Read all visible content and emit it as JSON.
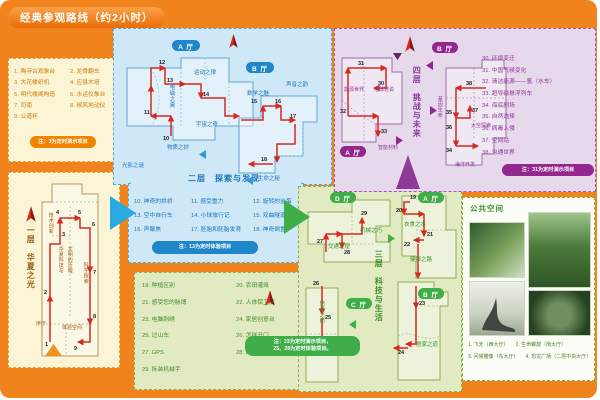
{
  "title": "经典参观路线（约2小时）",
  "colors": {
    "background_orange": "#f1831d",
    "route_red": "#d42b1e",
    "floor1_accent": "#cf7d0a",
    "floor2_accent": "#1b75bc",
    "floor3_accent": "#3e8f2f",
    "floor4_accent": "#8e3a96"
  },
  "floor1": {
    "title": "一层　华夏之光",
    "legend": [
      "1. 陶寺古观象台",
      "2. 龙骨翻车",
      "3. 大花楼织机",
      "4. 应县木塔",
      "5. 明代楼阁构造",
      "6. 水运仪象台",
      "7. 司南",
      "8. 候风地动仪",
      "9. 公道杯"
    ],
    "note": "注：3为定时演示项目",
    "areas": {
      "xu": "序厅",
      "jishu": "技术创新",
      "center1": "华夏科技与",
      "center2": "文明的历程",
      "kexue": "科学探索",
      "tiyan": "体验空间"
    },
    "route": [
      "1",
      "2",
      "3",
      "4",
      "5",
      "6",
      "7",
      "8",
      "9"
    ]
  },
  "floor2": {
    "title": "二层　探索与发现",
    "halls": [
      "A 厅",
      "B 厅"
    ],
    "areas": {
      "guangying": "光影之谜",
      "dianci": "电磁之奥",
      "yundong": "运动之律",
      "yuzhou": "宇宙之奇",
      "wuzhi": "物质之妙",
      "shuxue": "数学之魅",
      "shengyin": "声音之韵",
      "shengming": "生命之秘"
    },
    "legend": [
      "10. 神奇的拱桥",
      "11. 感受重力",
      "12. 旋转的金蛋",
      "13. 空中自行车",
      "14. 小球旅行记",
      "15. 双曲隧道",
      "16. 声聚焦",
      "17. 胚胎和胚胎发育",
      "18. 神奇倒置"
    ],
    "note": "注：13为定时体验项目",
    "route": [
      "10",
      "11",
      "12",
      "13",
      "14",
      "15",
      "16",
      "17",
      "18"
    ]
  },
  "floor3": {
    "title": "三层　科技与生活",
    "halls": [
      "A 厅",
      "B 厅",
      "C 厅",
      "D 厅"
    ],
    "areas": {
      "jiaotong": "交通之便",
      "jixie": "机械之巧",
      "yishi": "衣食之本",
      "jiankang": "健康之路",
      "xinxi": "信息之桥",
      "jujia": "居家之道"
    },
    "legend": [
      "19. 种植区别",
      "20. 农田灌溉",
      "21. 感受您的脉搏",
      "22. 人体保卫战",
      "23. 电脑刺绣",
      "24. 家居创意台",
      "25. 过山车",
      "26. 怎样开门",
      "27. GPS",
      "28. 螺旋推进器",
      "29. 拆装机械手"
    ],
    "note_line1": "注：23为定时演示项目，",
    "note_line2": "25、28为定时体验项目。",
    "route": [
      "19",
      "20",
      "21",
      "22",
      "23",
      "24",
      "25",
      "26",
      "27",
      "28",
      "29"
    ]
  },
  "floor4": {
    "title": "四层　挑战与未来",
    "halls": [
      "A 厅",
      "B 厅"
    ],
    "areas": {
      "nengyuan": "能源世界",
      "diqiu": "地球述说",
      "cailiao": "智能材料",
      "jiyin": "基因生命",
      "taikong": "太空探索",
      "haiyang": "海洋开发"
    },
    "legend": [
      "30. 环境变迁",
      "31. 中国气候变化",
      "32. 清洁能源——氢（水车）",
      "33. 超导磁悬浮列车",
      "34. 海底剧场",
      "35. 自然选择",
      "36. 病毒入侵",
      "37. 空间站",
      "38. 沟通世界"
    ],
    "note": "注：31为定时演示项目",
    "route": [
      "30",
      "31",
      "32",
      "33",
      "34",
      "35",
      "36",
      "37",
      "38"
    ]
  },
  "public_space": {
    "title": "公共空间",
    "captions": [
      "1. 飞天（西大厅）",
      "2. 生命螺旋（南大厅）",
      "3. 问候雕像（东大厅）",
      "4. 恐龙广场（二层中央大厅）"
    ]
  }
}
